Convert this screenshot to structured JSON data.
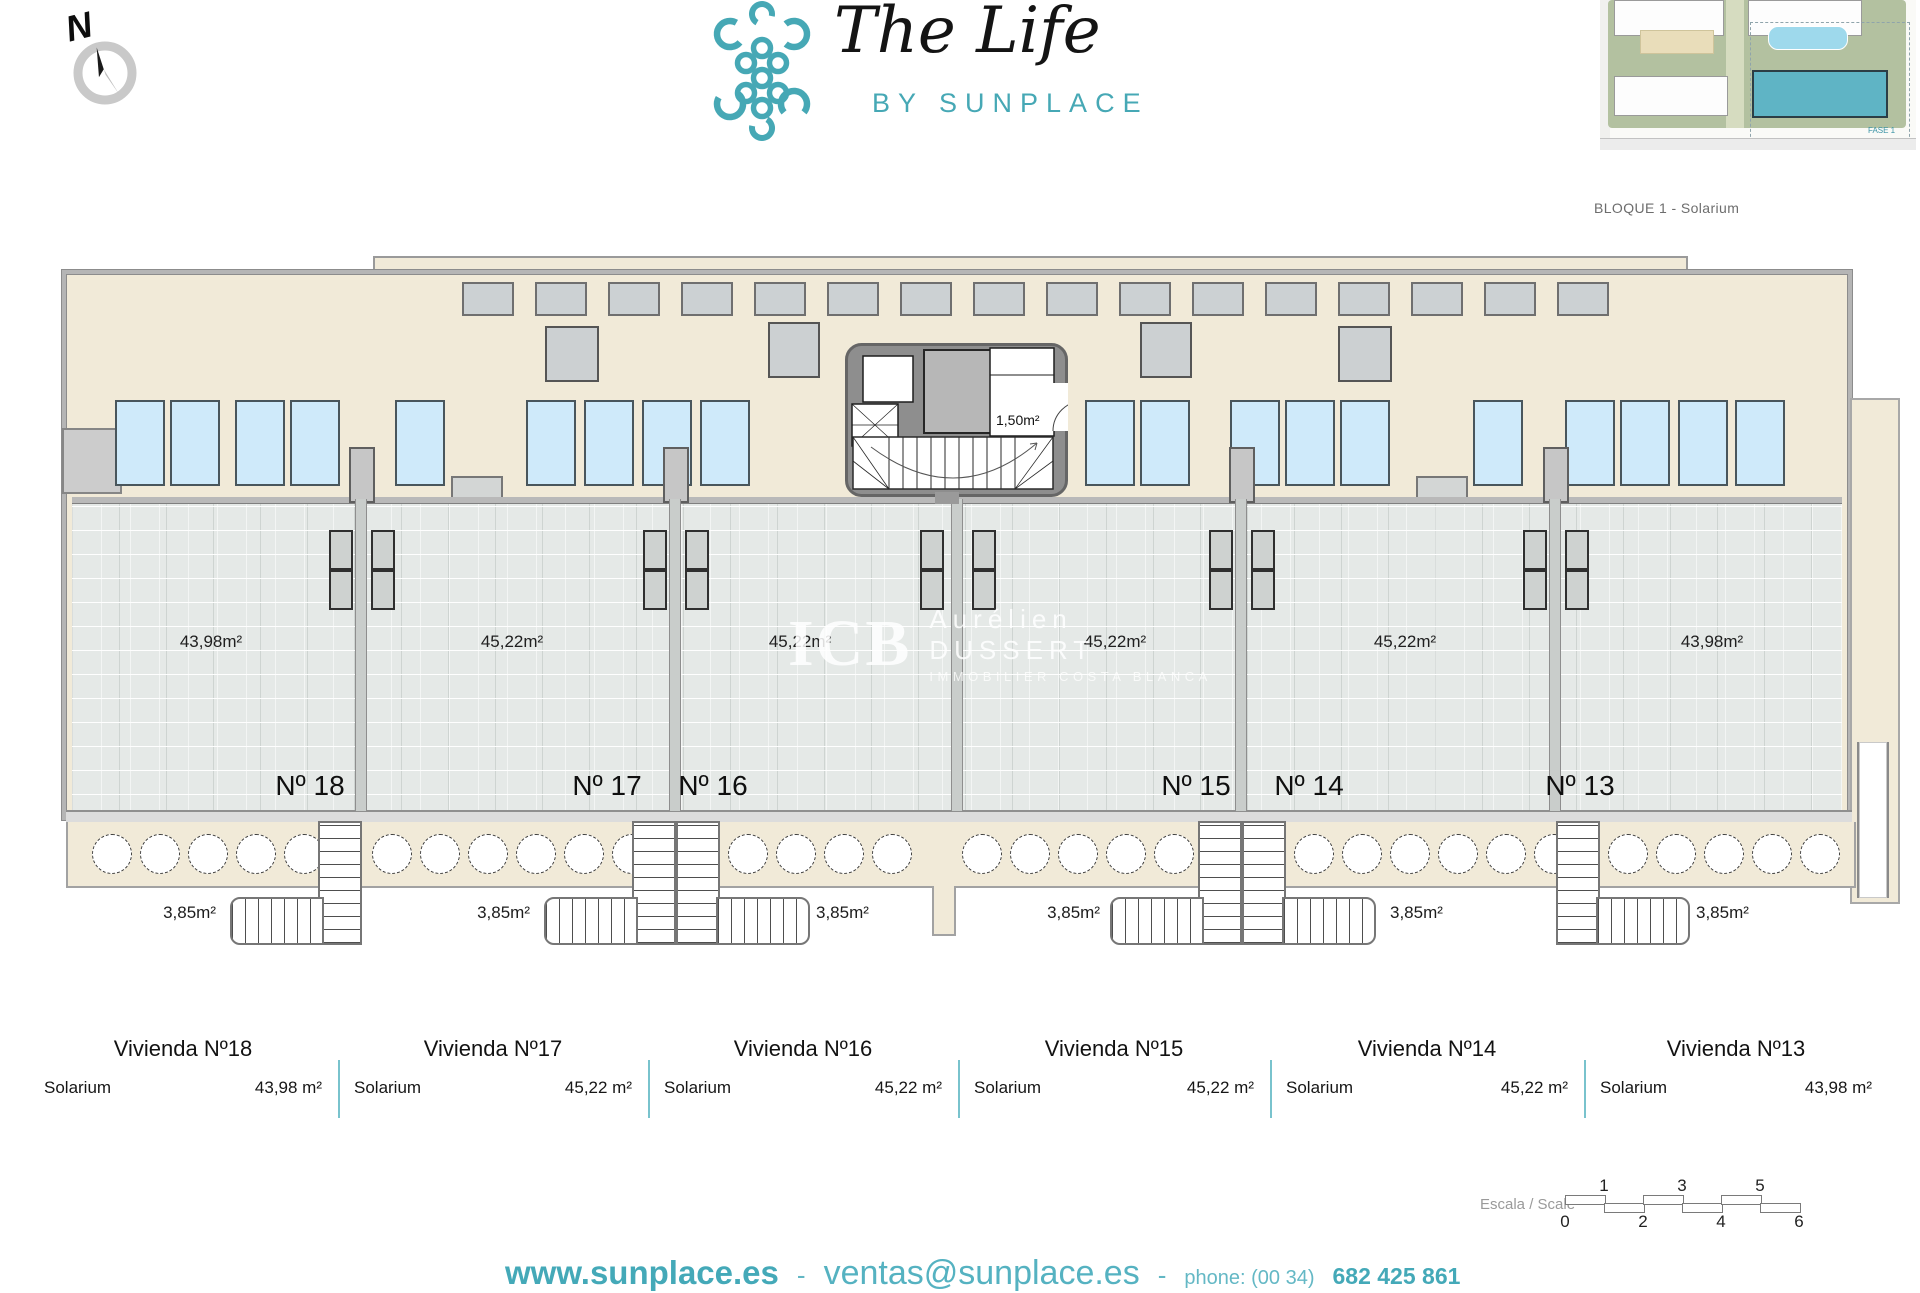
{
  "header": {
    "compass_label": "N",
    "logo_title": "The Life",
    "logo_subtitle": "BY SUNPLACE",
    "site_plan_caption": "BLOQUE 1 - Solarium",
    "site_plan_fase_label": "FASE 1"
  },
  "floor_plan": {
    "core_room_area": "1,50m²",
    "units": [
      {
        "number": "Nº 18",
        "area": "43,98m²"
      },
      {
        "number": "Nº 17",
        "area": "45,22m²"
      },
      {
        "number": "Nº 16",
        "area": "45,22m²"
      },
      {
        "number": "Nº 15",
        "area": "45,22m²"
      },
      {
        "number": "Nº 14",
        "area": "45,22m²"
      },
      {
        "number": "Nº 13",
        "area": "43,98m²"
      }
    ],
    "stair_labels": [
      "3,85m²",
      "3,85m²",
      "3,85m²",
      "3,85m²",
      "3,85m²",
      "3,85m²"
    ]
  },
  "watermark": {
    "initials": "ICB",
    "name": "Aurélien DUSSERT",
    "tagline": "IMMOBILIER COSTA BLANCA"
  },
  "summary_table": {
    "columns": [
      {
        "title": "Vivienda Nº18",
        "label": "Solarium",
        "value": "43,98 m²"
      },
      {
        "title": "Vivienda Nº17",
        "label": "Solarium",
        "value": "45,22 m²"
      },
      {
        "title": "Vivienda Nº16",
        "label": "Solarium",
        "value": "45,22 m²"
      },
      {
        "title": "Vivienda Nº15",
        "label": "Solarium",
        "value": "45,22 m²"
      },
      {
        "title": "Vivienda Nº14",
        "label": "Solarium",
        "value": "45,22 m²"
      },
      {
        "title": "Vivienda Nº13",
        "label": "Solarium",
        "value": "43,98 m²"
      }
    ]
  },
  "scale_bar": {
    "label": "Escala / Scale",
    "top_ticks": [
      "1",
      "3",
      "5"
    ],
    "bottom_ticks": [
      "0",
      "2",
      "4",
      "6"
    ]
  },
  "footer": {
    "website": "www.sunplace.es",
    "sep1": "-",
    "email": "ventas@sunplace.es",
    "sep2": "-",
    "phone_label": "phone: (00 34)",
    "phone_number": "682 425 861"
  },
  "colors": {
    "teal": "#46a8b5",
    "beige": "#f1ead8",
    "lounger_blue": "#cfeafa",
    "tile_gray": "#e5e9e7",
    "table_separator": "#79c3cd"
  }
}
